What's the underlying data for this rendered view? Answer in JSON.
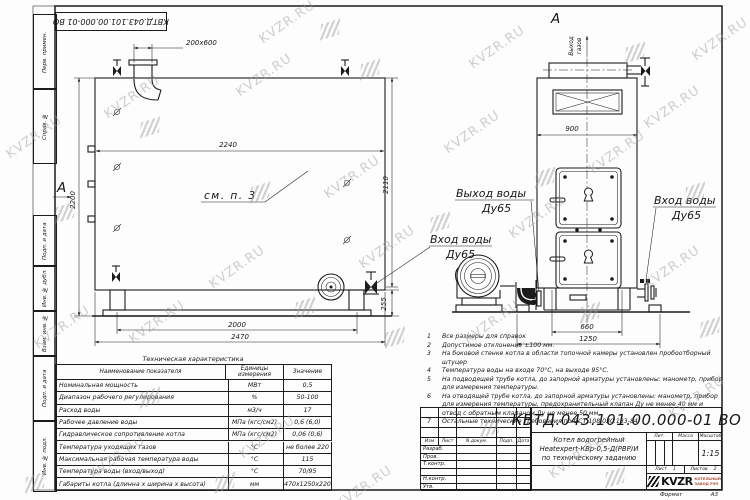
{
  "page": {
    "doc_number": "КВТД.043.101.00.000-01 ВО",
    "watermark_text": "KVZR.RU",
    "format_label": "Формат",
    "format_value": "А3"
  },
  "frame": {
    "left_labels": [
      "Перв. примен.",
      "Справ. №",
      "Подп. и дата",
      "Инв. № дубл.",
      "Взам. инв. №",
      "Подп. и дата",
      "Инв. № подл."
    ]
  },
  "drawing": {
    "section_letter": "А",
    "see_note": "см. п. 3",
    "dims": {
      "duct": "200x600",
      "width_top": "2240",
      "height_left": "2200",
      "height_right": "2110",
      "leg": "255",
      "base_inner": "2000",
      "base_outer": "2470",
      "front_width": "900",
      "front_base_inner": "660",
      "front_base_outer": "1250"
    },
    "labels": {
      "water_out": "Выход воды",
      "water_in": "Вход воды",
      "dy": "Ду65",
      "gas_out_1": "Выход",
      "gas_out_2": "газов"
    }
  },
  "notes": {
    "items": [
      {
        "num": "1",
        "text": "Все размеры для справок"
      },
      {
        "num": "2",
        "text": "Допустимое отклонение ±100 мм."
      },
      {
        "num": "3",
        "text": "На боковой стенке котла в области топочной камеры установлен пробоотборный штуцер"
      },
      {
        "num": "4",
        "text": "Температура воды на входе 70°С, на выходе 95°С."
      },
      {
        "num": "5",
        "text": "На подводящей трубе котла, до запорной арматуры установлены: манометр, прибор для измерения температуры."
      },
      {
        "num": "6",
        "text": "На отводящей трубе котла, до запорной арматуры установлены: манометр, прибор для измерения температуры, предохранительный клапан Ду не менее 40 мм и отвод с обратным клапаном Ду не менее 50 мм."
      },
      {
        "num": "7",
        "text": "Остальные технические требования по ОСТ 108.030.133-84."
      }
    ]
  },
  "tech_table": {
    "title": "Техническая характеристика",
    "headers": [
      "Наименование показателя",
      "Единицы измерения",
      "Значение"
    ],
    "rows": [
      [
        "Номинальная мощность",
        "МВт",
        "0,5"
      ],
      [
        "Диапазон рабочего регулирования",
        "%",
        "50-100"
      ],
      [
        "Расход воды",
        "м3/ч",
        "17"
      ],
      [
        "Рабочее давление воды",
        "МПа (кгс/см2)",
        "0,6 (6,0)"
      ],
      [
        "Гидравлическое сопротивление котла",
        "МПа (кгс/см2)",
        "0,06 (0,6)"
      ],
      [
        "Температура уходящих газов",
        "°С",
        "не более 220"
      ],
      [
        "Максимальная рабочая температура воды",
        "°С",
        "115"
      ],
      [
        "Температура воды (вход/выход)",
        "°С",
        "70/95"
      ],
      [
        "Габариты котла (длинна х ширина х высота)",
        "мм",
        "2470х1250х2200"
      ]
    ]
  },
  "title_block": {
    "doc_number": "КВТД.043.101.00.000-01 ВО",
    "cols": [
      "Изм",
      "Лист",
      "N докум.",
      "Подп.",
      "Дата"
    ],
    "rows": [
      "Разраб.",
      "Пров.",
      "Т.контр.",
      "",
      "Н.контр.",
      "Утв."
    ],
    "product": [
      "Котел водогрейный",
      "Heatexpert-КВр-0,5-Д(РВР)И",
      "по техническому заданию"
    ],
    "lit_label": "Лит.",
    "mass_label": "Масса",
    "scale_label": "Масштаб",
    "scale_value": "1:15",
    "sheet_label": "Лист",
    "sheet_value": "1",
    "sheets_label": "Листов",
    "sheets_value": "2",
    "logo_text": "KVZR",
    "logo_sub1": "КОТЕЛЬНЫЙ",
    "logo_sub2": "ЗАВОД РЭП"
  }
}
